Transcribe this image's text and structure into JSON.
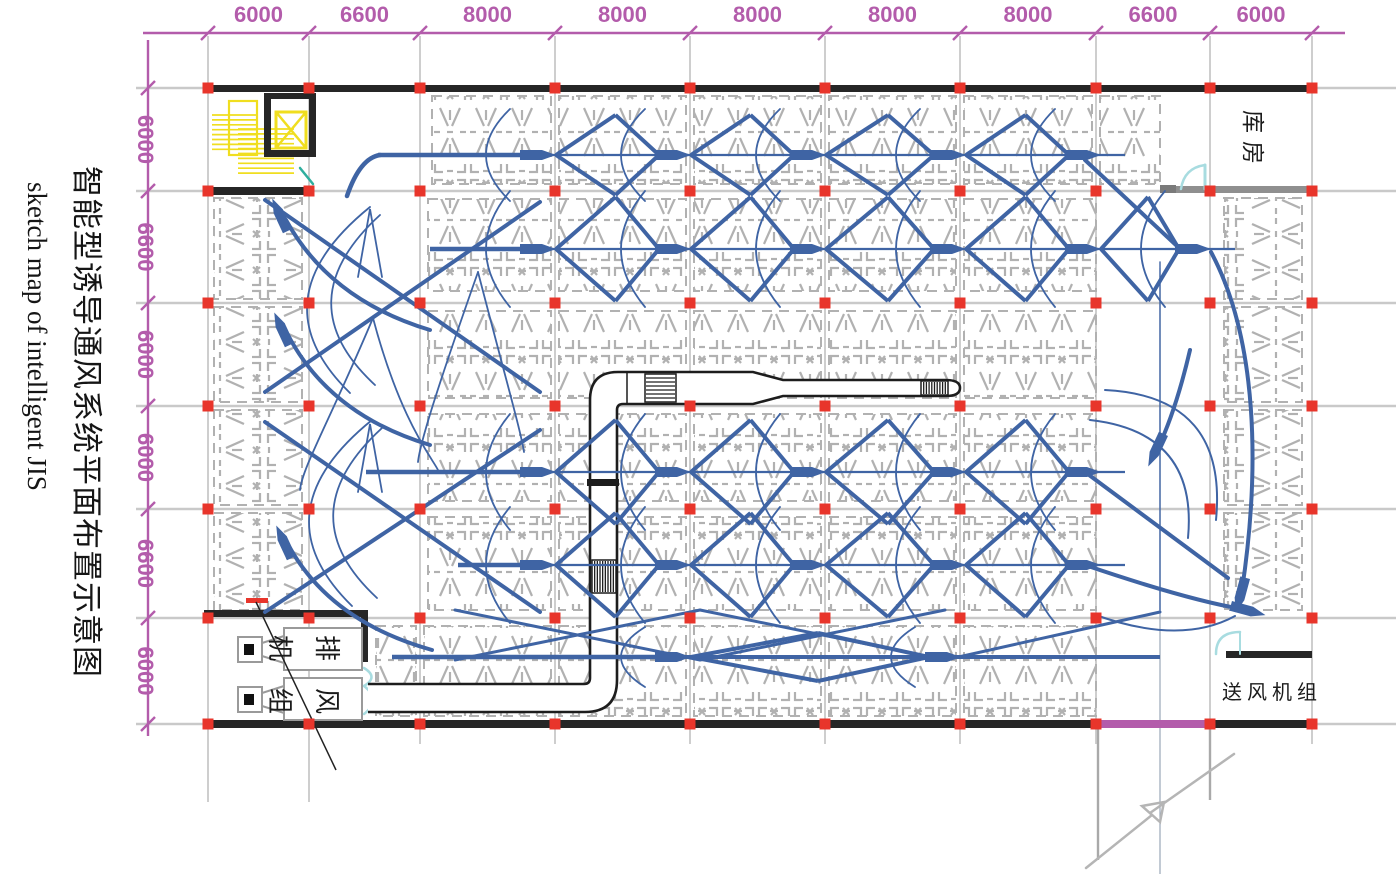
{
  "title": {
    "zh": "智能型诱导通风系统平面布置示意图",
    "en": "sketch map of intelligent JIS"
  },
  "dimensions": {
    "top": [
      "6000",
      "6600",
      "8000",
      "8000",
      "8000",
      "8000",
      "8000",
      "6600",
      "6000"
    ],
    "left": [
      "6000",
      "6600",
      "6000",
      "6000",
      "6600",
      "6000"
    ]
  },
  "labels": {
    "storehouse": "库房",
    "supply_unit": "送风机组",
    "exhaust_unit_chars": [
      "机",
      "排",
      "组",
      "风"
    ]
  },
  "colors": {
    "dim": "#b35cab",
    "red": "#e8352b",
    "blue": "#3f64a4",
    "yellow": "#f0de1f",
    "teal": "#a8dce0",
    "teal_dark": "#2fae9e",
    "parking": "#b1b1b1",
    "grid": "#c9c9c9",
    "wall": "#262626",
    "wall_gray": "#8f8f8f",
    "purple_wall": "#b35cab"
  },
  "grid": {
    "cols": [
      208,
      309,
      420,
      555,
      690,
      825,
      960,
      1096,
      1210,
      1312
    ],
    "rows": [
      88,
      191,
      303,
      406,
      509,
      618,
      724
    ],
    "row_x1": 136,
    "row_x2": 1396,
    "col_y1": 36,
    "col_y2": 744,
    "col_ext": [
      [
        208,
        744,
        802
      ],
      [
        309,
        744,
        802
      ]
    ]
  },
  "dim_lines": {
    "top_y": 33,
    "top_x1": 143,
    "top_x2": 1345,
    "top_label_y": 22,
    "left_x": 148,
    "left_y1": 40,
    "left_y2": 736,
    "left_label_x": 138
  },
  "parking": {
    "h_bands": [
      {
        "x1": 432,
        "x2": 1160,
        "y1": 96,
        "y2": 184
      },
      {
        "x1": 428,
        "x2": 1096,
        "y1": 199,
        "y2": 291
      },
      {
        "x1": 428,
        "x2": 1096,
        "y1": 311,
        "y2": 398
      },
      {
        "x1": 428,
        "x2": 1096,
        "y1": 414,
        "y2": 501
      },
      {
        "x1": 428,
        "x2": 1096,
        "y1": 517,
        "y2": 610
      },
      {
        "x1": 376,
        "x2": 1096,
        "y1": 626,
        "y2": 716
      }
    ],
    "v_strips": [
      {
        "x1": 214,
        "x2": 302,
        "y1": 198,
        "y2": 610
      },
      {
        "x1": 1224,
        "x2": 1302,
        "y1": 198,
        "y2": 610
      }
    ]
  },
  "walls": {
    "black": [
      [
        204,
        85,
        1111,
        7
      ],
      [
        204,
        187,
        110,
        8
      ],
      [
        204,
        720,
        894,
        8
      ],
      [
        1210,
        720,
        105,
        8
      ],
      [
        204,
        610,
        164,
        7
      ],
      [
        361,
        610,
        7,
        52
      ],
      [
        1226,
        651,
        86,
        7
      ]
    ],
    "purple": [
      1098,
      720,
      112,
      8
    ],
    "gray": [
      [
        1176,
        186,
        139,
        7
      ]
    ],
    "dark_gray": [
      [
        1160,
        185,
        16,
        8
      ]
    ]
  },
  "ramp": {
    "verticals": [
      [
        1098,
        728,
        860
      ],
      [
        1210,
        728,
        800
      ]
    ],
    "thin_line": [
      1160,
      268,
      874
    ],
    "break_path": "M1086,868 L1152,815 l-10,-9 22,-4 -4,20 -10,-9 L1234,754"
  },
  "ducts": {
    "outline": "M368,684 L584,684 Q590,684 590,678 L590,400 Q590,372 618,372 L753,372 L783,380 L946,380 Q960,380 960,388 Q960,396 946,396 L783,396 L753,404 L623,404 Q617,404 617,410 L617,680 Q617,712 585,712 L368,712",
    "divider": "M627,372 L627,404",
    "joint": [
      587,
      479,
      32,
      7
    ],
    "grilles": [
      {
        "x": 645,
        "y": 374,
        "w": 31,
        "h": 28,
        "n": 6,
        "vert": false
      },
      {
        "x": 921,
        "y": 381,
        "w": 27,
        "h": 14,
        "n": 9,
        "vert": true
      },
      {
        "x": 592,
        "y": 560,
        "w": 24,
        "h": 33,
        "n": 8,
        "vert": true
      }
    ]
  },
  "flow": {
    "chains": [
      {
        "y": 155,
        "xs": [
          540,
          675,
          810,
          950,
          1085
        ],
        "spread": 40,
        "jet_from": 378
      },
      {
        "y": 249,
        "xs": [
          540,
          675,
          810,
          950,
          1085,
          1195
        ],
        "spread": 52,
        "jet_from": 430
      },
      {
        "y": 472,
        "xs": [
          540,
          675,
          810,
          950,
          1085
        ],
        "spread": 52,
        "jet_from": 366
      },
      {
        "y": 565,
        "xs": [
          540,
          675,
          810,
          950,
          1085
        ],
        "spread": 52,
        "jet_from": 458
      },
      {
        "y": 657,
        "xs": [
          675,
          945
        ],
        "spread": 24,
        "jet_from": 392,
        "jet_to": 1160
      }
    ],
    "arrows": [
      {
        "x": 279,
        "y": 213,
        "a": -115
      },
      {
        "x": 281,
        "y": 327,
        "a": -115
      },
      {
        "x": 283,
        "y": 540,
        "a": -115
      },
      {
        "x": 1240,
        "y": 597,
        "a": 105
      },
      {
        "x": 1155,
        "y": 452,
        "a": 115
      },
      {
        "x": 1250,
        "y": 611,
        "a": 15
      }
    ],
    "curves": [
      {
        "d": "M347,196 Q360,158 380,155",
        "w": 4.5
      },
      {
        "d": "M430,330 Q330,300 286,220",
        "w": 4
      },
      {
        "d": "M430,445 Q330,415 288,335",
        "w": 4
      },
      {
        "d": "M432,650 Q332,622 290,548",
        "w": 4
      },
      {
        "d": "M370,207 Q255,300 350,393",
        "w": 1.8
      },
      {
        "d": "M380,215 Q285,302 375,385",
        "w": 1.8
      },
      {
        "d": "M372,420 Q257,513 352,606",
        "w": 1.8
      },
      {
        "d": "M382,428 Q287,515 377,598",
        "w": 1.8
      },
      {
        "d": "M358,277 L370,209 L382,277",
        "w": 1.8
      },
      {
        "d": "M358,492 L370,424 L382,492",
        "w": 1.8
      },
      {
        "d": "M265,200 L540,392",
        "w": 4
      },
      {
        "d": "M265,392 L540,202",
        "w": 4
      },
      {
        "d": "M265,422 L540,612",
        "w": 4
      },
      {
        "d": "M265,612 L540,430",
        "w": 4
      },
      {
        "d": "M373,318 C330,420 302,468 300,490",
        "w": 1.8
      },
      {
        "d": "M373,318 C400,420 432,458 438,470",
        "w": 1.8
      },
      {
        "d": "M478,272 C440,380 420,442 418,462",
        "w": 1.8
      },
      {
        "d": "M478,272 C506,380 521,432 524,452",
        "w": 1.8
      },
      {
        "d": "M1085,160 L1177,246",
        "w": 4
      },
      {
        "d": "M1211,252 C1258,340 1260,470 1242,590",
        "w": 4
      },
      {
        "d": "M1160,262 L1160,610",
        "w": 1.4
      },
      {
        "d": "M1105,390 Q1228,396 1216,520",
        "w": 2
      },
      {
        "d": "M1090,420 Q1198,432 1188,538",
        "w": 2
      },
      {
        "d": "M1190,350 Q1176,410 1158,448",
        "w": 4
      },
      {
        "d": "M1085,472 L1228,578",
        "w": 4
      },
      {
        "d": "M1085,565 Q1188,600 1242,609",
        "w": 4
      },
      {
        "d": "M1093,614 Q1180,646 1235,616",
        "w": 2
      },
      {
        "d": "M455,610 L700,660",
        "w": 3
      },
      {
        "d": "M700,610 L455,660",
        "w": 3
      },
      {
        "d": "M700,610 L945,660",
        "w": 3
      },
      {
        "d": "M945,610 L700,660",
        "w": 3
      },
      {
        "d": "M945,660 L1160,612",
        "w": 3
      }
    ]
  },
  "equipment": {
    "fan_units_y": [
      628,
      678
    ],
    "red_damper": [
      246,
      598,
      22,
      5
    ],
    "leader": "M256,602 L336,770",
    "stairs": {
      "treads1": {
        "x1": 212,
        "x2": 258,
        "y0": 115,
        "n": 8,
        "dy": 4.9
      },
      "treads2": {
        "x1": 238,
        "x2": 294,
        "y0": 129,
        "n": 10,
        "dy": 4.9
      },
      "outline": [
        229,
        101,
        28,
        54
      ],
      "shaft_walls": [
        [
          264,
          93,
          52,
          6
        ],
        [
          264,
          150,
          52,
          7
        ],
        [
          264,
          93,
          7,
          64
        ],
        [
          309,
          93,
          7,
          64
        ]
      ],
      "car": [
        276,
        112,
        30,
        36
      ]
    },
    "doors": {
      "storehouse_arc": "M1181,189 Q1184,168 1205,165",
      "storehouse_leaf": "M1205,165 L1205,189",
      "supply_arc": "M1216,654 Q1216,632 1240,632",
      "supply_leaf": "M1240,632 L1240,654",
      "exhaust_double": [
        "M364,686 Q382,700 364,714",
        "M364,668 Q379,677 364,686"
      ],
      "stair_teal": "M300,168 L313,184"
    }
  }
}
